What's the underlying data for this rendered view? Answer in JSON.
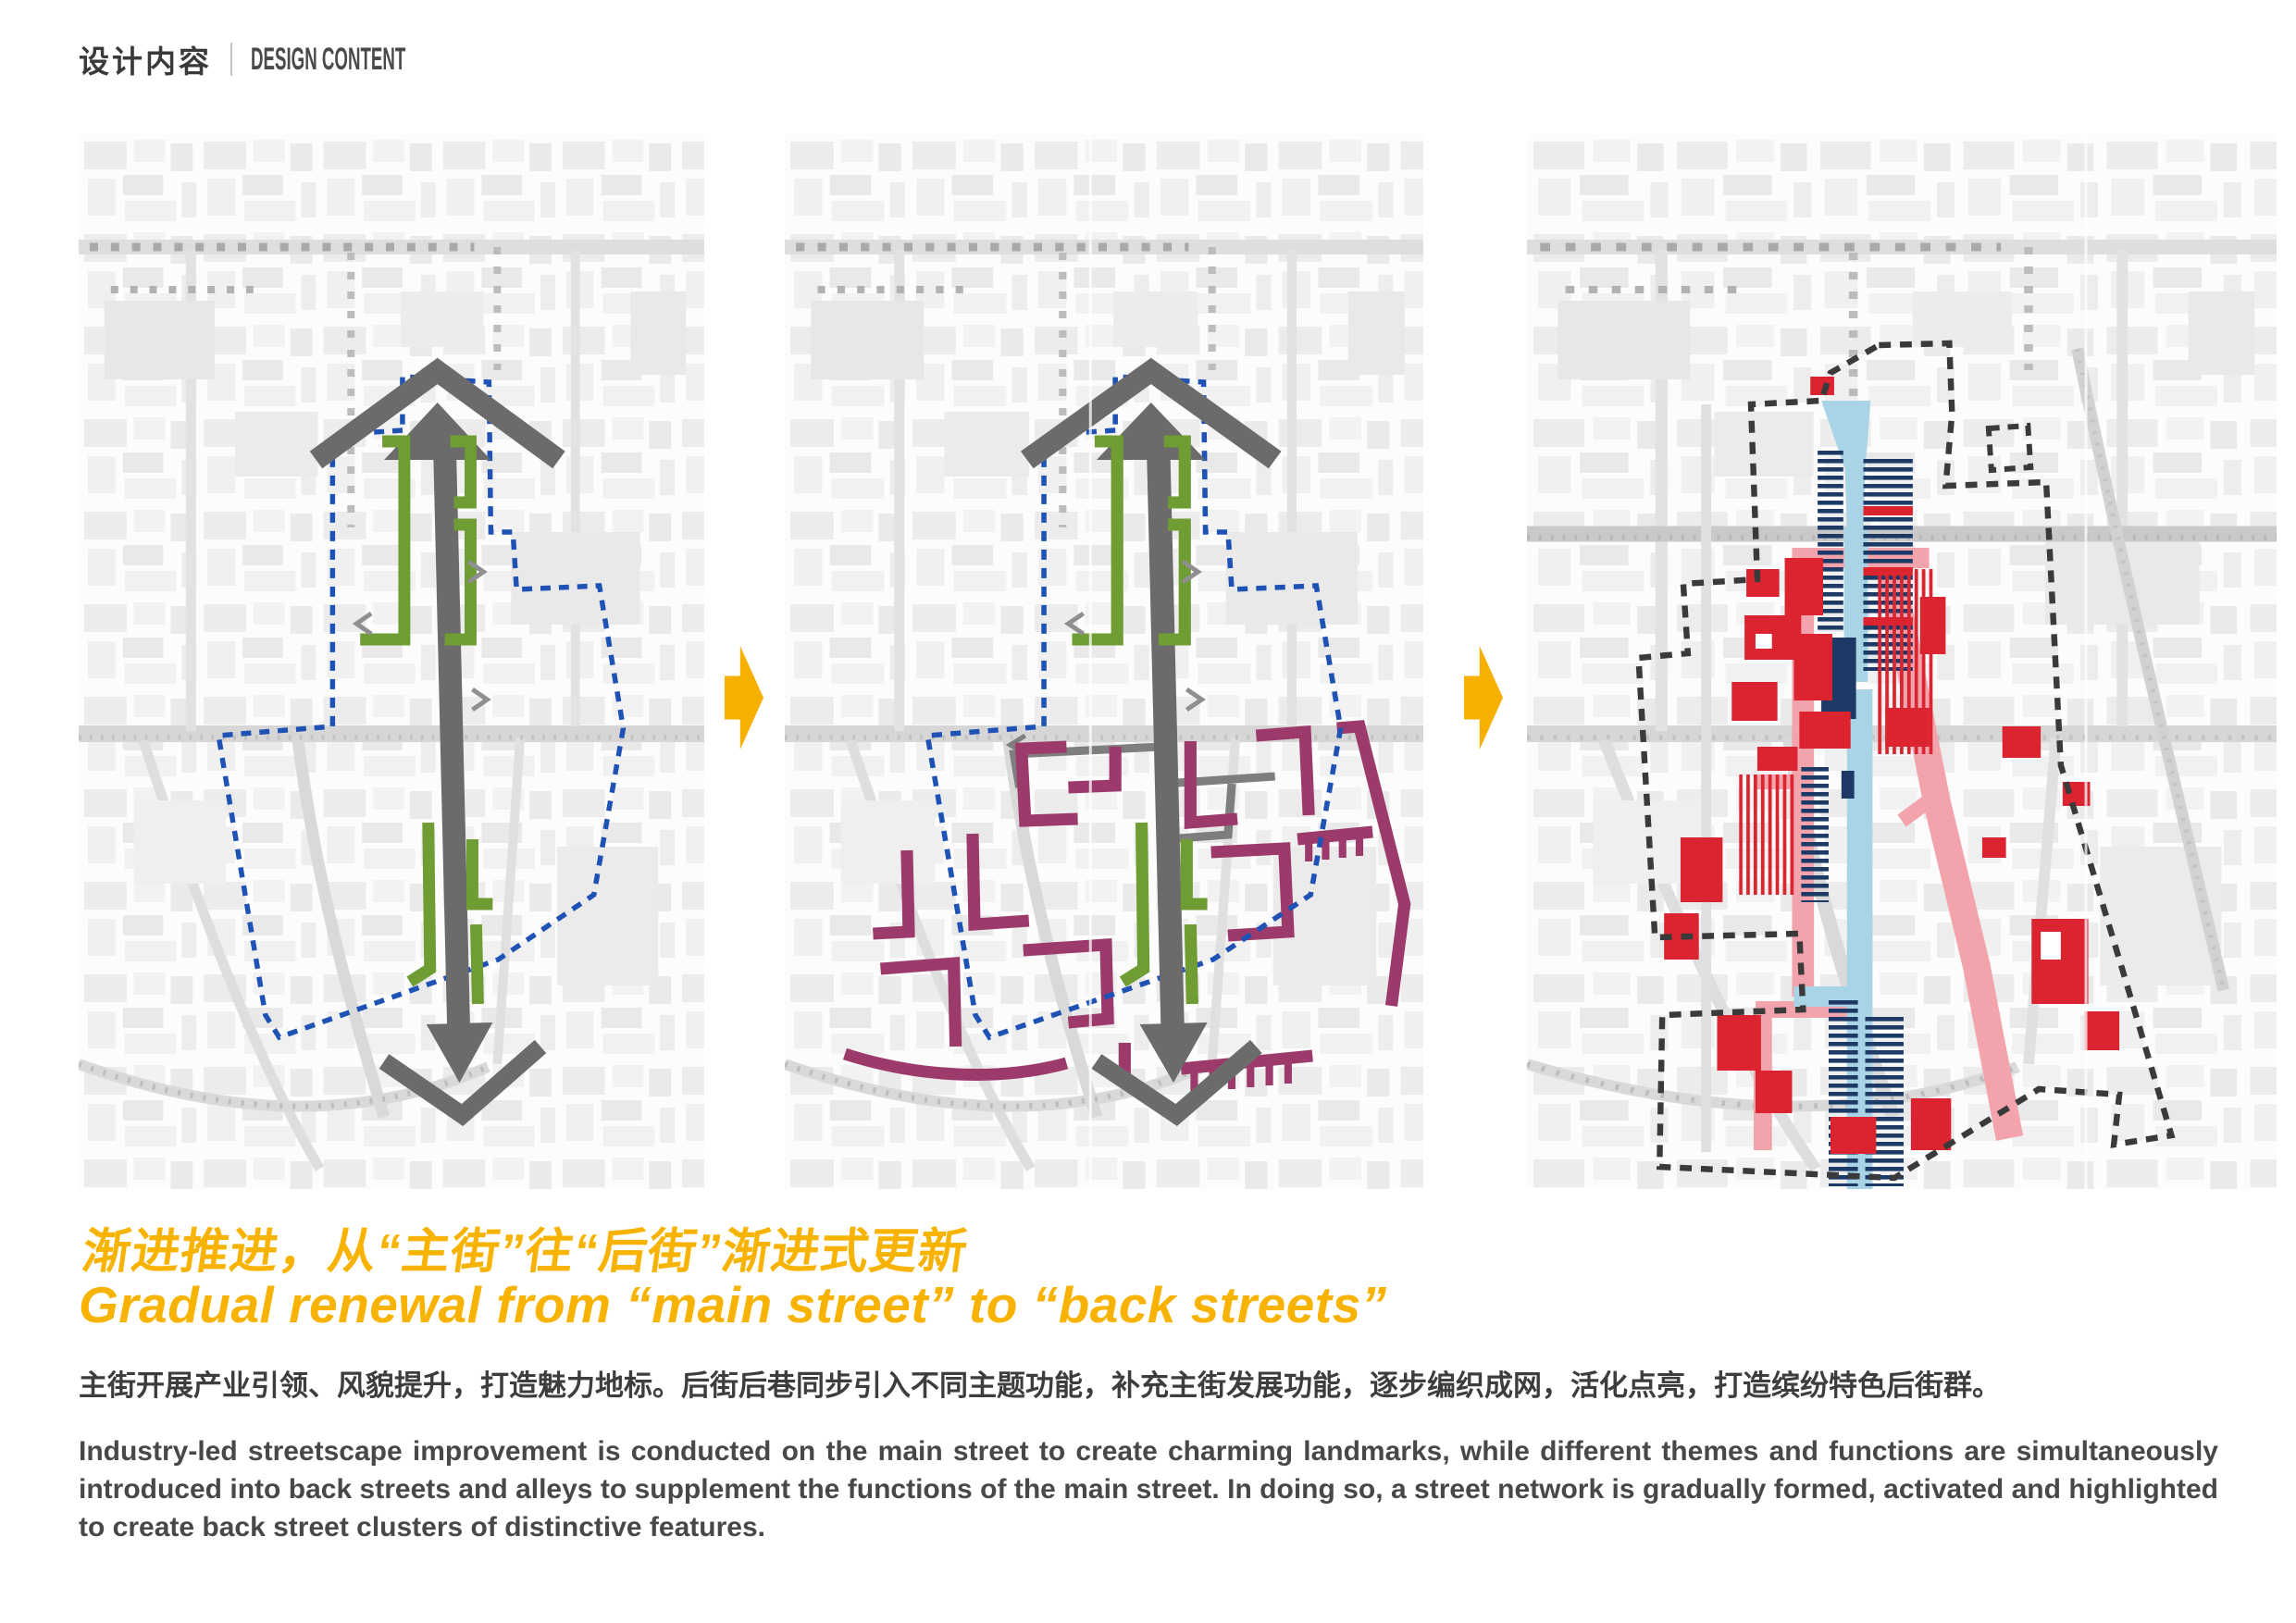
{
  "header": {
    "zh": "设计内容",
    "en": "DESIGN CONTENT"
  },
  "title": {
    "zh": "渐进推进，从“主街”往“后街”渐进式更新",
    "en": "Gradual renewal from “main street” to “back streets”"
  },
  "body": {
    "zh": "主街开展产业引领、风貌提升，打造魅力地标。后街后巷同步引入不同主题功能，补充主街发展功能，逐步编织成网，活化点亮，打造缤纷特色后街群。",
    "en": "Industry-led streetscape improvement is conducted on the main street to create charming landmarks, while different themes and functions are simultaneously introduced into back streets and alleys to supplement the functions of the main street. In doing so, a street network is gradually formed, activated and highlighted to create back street clusters of distinctive features."
  },
  "icons": {
    "stage_arrow": "right-arrow"
  },
  "colors": {
    "accent_gold": "#F8B301",
    "arrow_gold": "#F6B000",
    "main_street_gray": "#6B6B6B",
    "stage_green": "#6F9C33",
    "back_street_magenta": "#9C3A6C",
    "boundary_blue": "#1F52B5",
    "boundary_black": "#3A3A3A",
    "main_street_cyan": "#A9D4E6",
    "frontage_navy": "#1D3A66",
    "building_red": "#DC2330",
    "street_pink": "#F2A3AB"
  }
}
